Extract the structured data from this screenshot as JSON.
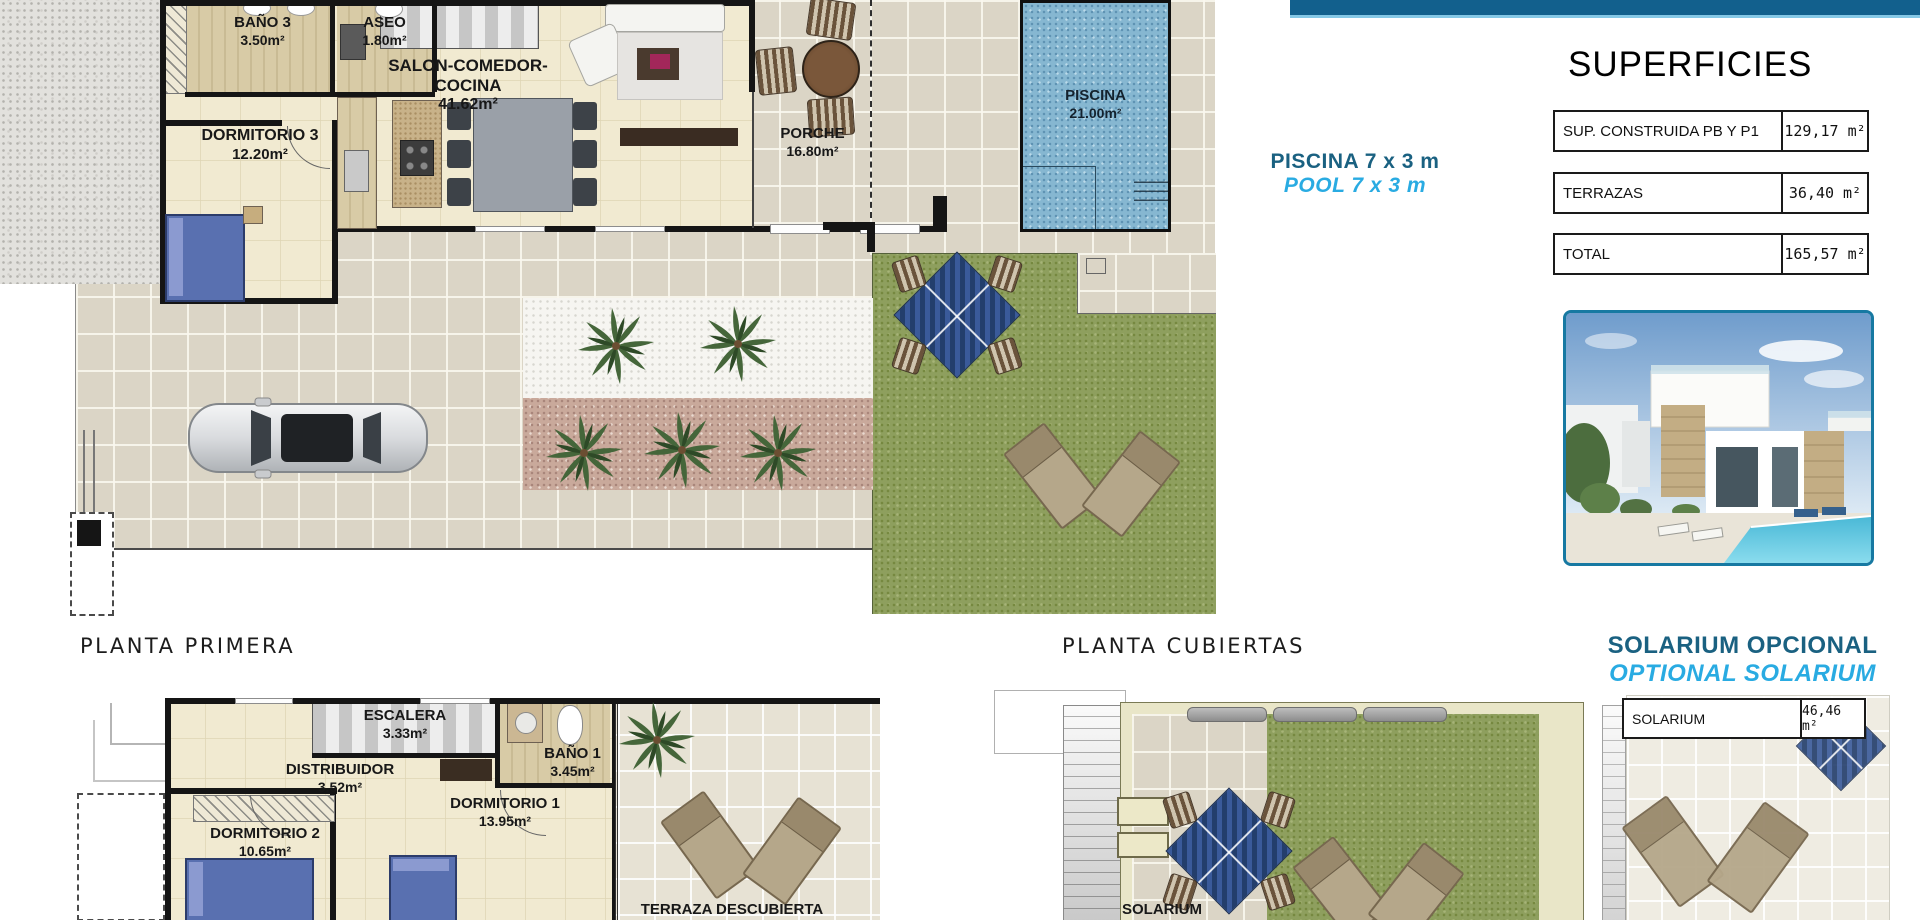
{
  "colors": {
    "topbar": "#12608D",
    "accent_dark_blue": "#1A6181",
    "accent_cyan": "#29ABE2",
    "pool_blue": "#86B7D1",
    "lawn_green": "#8E9F5E",
    "tile_beige": "#DBD5C6"
  },
  "plans": {
    "ground": {
      "rooms": [
        {
          "name": "BAÑO 3",
          "area": "3.50m²"
        },
        {
          "name": "ASEO",
          "area": "1.80m²"
        },
        {
          "name": "SALON-COMEDOR-COCINA",
          "area": "41.62m²"
        },
        {
          "name": "DORMITORIO 3",
          "area": "12.20m²"
        },
        {
          "name": "PORCHE",
          "area": "16.80m²"
        },
        {
          "name": "PISCINA",
          "area": "21.00m²"
        }
      ]
    },
    "first": {
      "title": "PLANTA PRIMERA",
      "rooms": [
        {
          "name": "ESCALERA",
          "area": "3.33m²"
        },
        {
          "name": "DISTRIBUIDOR",
          "area": "3.52m²"
        },
        {
          "name": "BAÑO 1",
          "area": "3.45m²"
        },
        {
          "name": "DORMITORIO 1",
          "area": "13.95m²"
        },
        {
          "name": "DORMITORIO 2",
          "area": "10.65m²"
        },
        {
          "name": "TERRAZA DESCUBIERTA",
          "area": ""
        }
      ]
    },
    "roof": {
      "title": "PLANTA CUBIERTAS",
      "rooms": [
        {
          "name": "SOLARIUM",
          "area": ""
        }
      ]
    }
  },
  "sidebar": {
    "superficies": {
      "title": "SUPERFICIES",
      "rows": [
        {
          "label": "SUP. CONSTRUIDA PB Y P1",
          "value": "129,17 m²"
        },
        {
          "label": "TERRAZAS",
          "value": "36,40 m²"
        },
        {
          "label": "TOTAL",
          "value": "165,57 m²"
        }
      ]
    },
    "pool_note": {
      "es": "PISCINA 7 x 3 m",
      "en": "POOL 7 x 3 m"
    },
    "solarium_note": {
      "es": "SOLARIUM OPCIONAL",
      "en": "OPTIONAL SOLARIUM"
    },
    "solarium_row": {
      "label": "SOLARIUM",
      "value": "46,46 m²"
    }
  }
}
